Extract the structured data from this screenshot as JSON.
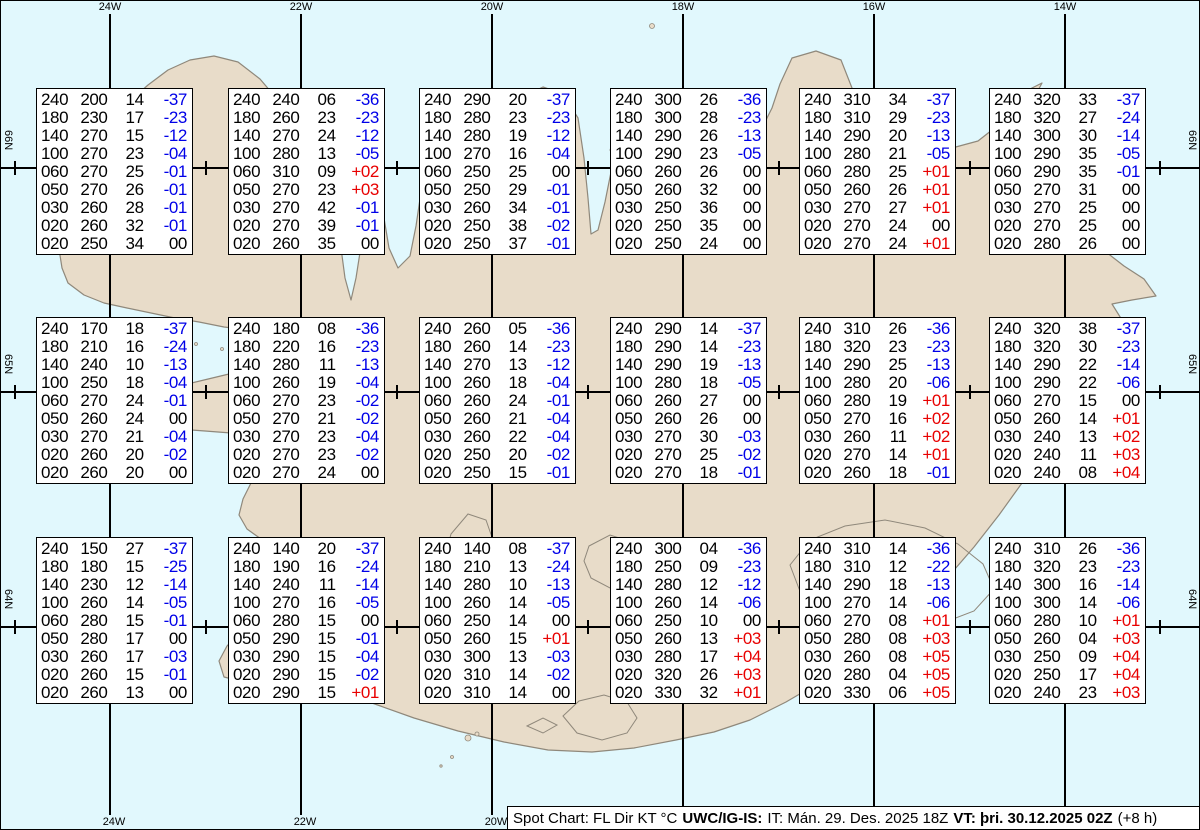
{
  "chart_title": "Spot Chart",
  "map": {
    "region": "Iceland",
    "colors": {
      "water": "#e1f8fd",
      "land": "#e8dcc9",
      "coast": "#8f887b",
      "glacier_outline": "#8d8d8d",
      "grid": "#000000"
    },
    "meridians": [
      {
        "label": "24W",
        "x": 110,
        "bottom_label": true
      },
      {
        "label": "22W",
        "x": 301,
        "bottom_label": true
      },
      {
        "label": "20W",
        "x": 492,
        "bottom_label": true
      },
      {
        "label": "18W",
        "x": 683,
        "bottom_label": false
      },
      {
        "label": "16W",
        "x": 874,
        "bottom_label": false
      },
      {
        "label": "14W",
        "x": 1065,
        "bottom_label": false
      }
    ],
    "parallels": [
      {
        "label": "66N",
        "y": 168
      },
      {
        "label": "65N",
        "y": 392
      },
      {
        "label": "64N",
        "y": 627
      }
    ],
    "half_degree_tick_x": [
      15,
      206,
      397,
      588,
      779,
      970,
      1160
    ]
  },
  "columns": {
    "flight_level": "FL",
    "direction": "Dir",
    "speed": "KT",
    "temperature": "°C"
  },
  "colors": {
    "negative_temp": "#0000e8",
    "positive_temp": "#e80000",
    "zero_temp": "#000000"
  },
  "status_bar": {
    "prefix": "Spot Chart: FL Dir KT °C",
    "source": "UWC/IG-IS:",
    "issue_time": "IT: Mán. 29. Des. 2025 18Z",
    "valid_time": "VT: þri. 30.12.2025 02Z",
    "offset": "(+8 h)"
  },
  "spot_boxes": [
    {
      "row": 0,
      "col": 0,
      "levels": [
        [
          "240",
          "200",
          "14",
          "-37"
        ],
        [
          "180",
          "230",
          "17",
          "-23"
        ],
        [
          "140",
          "270",
          "15",
          "-12"
        ],
        [
          "100",
          "270",
          "23",
          "-04"
        ],
        [
          "060",
          "270",
          "25",
          "-01"
        ],
        [
          "050",
          "270",
          "26",
          "-01"
        ],
        [
          "030",
          "260",
          "28",
          "-01"
        ],
        [
          "020",
          "260",
          "32",
          "-01"
        ],
        [
          "020",
          "250",
          "34",
          "00"
        ]
      ]
    },
    {
      "row": 0,
      "col": 1,
      "levels": [
        [
          "240",
          "240",
          "06",
          "-36"
        ],
        [
          "180",
          "260",
          "23",
          "-23"
        ],
        [
          "140",
          "270",
          "24",
          "-12"
        ],
        [
          "100",
          "280",
          "13",
          "-05"
        ],
        [
          "060",
          "310",
          "09",
          "+02"
        ],
        [
          "050",
          "270",
          "23",
          "+03"
        ],
        [
          "030",
          "270",
          "42",
          "-01"
        ],
        [
          "020",
          "270",
          "39",
          "-01"
        ],
        [
          "020",
          "260",
          "35",
          "00"
        ]
      ]
    },
    {
      "row": 0,
      "col": 2,
      "levels": [
        [
          "240",
          "290",
          "20",
          "-37"
        ],
        [
          "180",
          "280",
          "23",
          "-23"
        ],
        [
          "140",
          "280",
          "19",
          "-12"
        ],
        [
          "100",
          "270",
          "16",
          "-04"
        ],
        [
          "060",
          "250",
          "25",
          "00"
        ],
        [
          "050",
          "250",
          "29",
          "-01"
        ],
        [
          "030",
          "260",
          "34",
          "-01"
        ],
        [
          "020",
          "250",
          "38",
          "-02"
        ],
        [
          "020",
          "250",
          "37",
          "-01"
        ]
      ]
    },
    {
      "row": 0,
      "col": 3,
      "levels": [
        [
          "240",
          "300",
          "26",
          "-36"
        ],
        [
          "180",
          "300",
          "28",
          "-23"
        ],
        [
          "140",
          "290",
          "26",
          "-13"
        ],
        [
          "100",
          "290",
          "23",
          "-05"
        ],
        [
          "060",
          "260",
          "26",
          "00"
        ],
        [
          "050",
          "260",
          "32",
          "00"
        ],
        [
          "030",
          "250",
          "36",
          "00"
        ],
        [
          "020",
          "250",
          "35",
          "00"
        ],
        [
          "020",
          "250",
          "24",
          "00"
        ]
      ]
    },
    {
      "row": 0,
      "col": 4,
      "levels": [
        [
          "240",
          "310",
          "34",
          "-37"
        ],
        [
          "180",
          "310",
          "29",
          "-23"
        ],
        [
          "140",
          "290",
          "20",
          "-13"
        ],
        [
          "100",
          "280",
          "21",
          "-05"
        ],
        [
          "060",
          "280",
          "25",
          "+01"
        ],
        [
          "050",
          "260",
          "26",
          "+01"
        ],
        [
          "030",
          "270",
          "27",
          "+01"
        ],
        [
          "020",
          "270",
          "24",
          "00"
        ],
        [
          "020",
          "270",
          "24",
          "+01"
        ]
      ]
    },
    {
      "row": 0,
      "col": 5,
      "levels": [
        [
          "240",
          "320",
          "33",
          "-37"
        ],
        [
          "180",
          "320",
          "27",
          "-24"
        ],
        [
          "140",
          "300",
          "30",
          "-14"
        ],
        [
          "100",
          "290",
          "35",
          "-05"
        ],
        [
          "060",
          "290",
          "35",
          "-01"
        ],
        [
          "050",
          "270",
          "31",
          "00"
        ],
        [
          "030",
          "270",
          "25",
          "00"
        ],
        [
          "020",
          "270",
          "25",
          "00"
        ],
        [
          "020",
          "280",
          "26",
          "00"
        ]
      ]
    },
    {
      "row": 1,
      "col": 0,
      "levels": [
        [
          "240",
          "170",
          "18",
          "-37"
        ],
        [
          "180",
          "210",
          "16",
          "-24"
        ],
        [
          "140",
          "240",
          "10",
          "-13"
        ],
        [
          "100",
          "250",
          "18",
          "-04"
        ],
        [
          "060",
          "270",
          "24",
          "-01"
        ],
        [
          "050",
          "260",
          "24",
          "00"
        ],
        [
          "030",
          "270",
          "21",
          "-04"
        ],
        [
          "020",
          "260",
          "20",
          "-02"
        ],
        [
          "020",
          "260",
          "20",
          "00"
        ]
      ]
    },
    {
      "row": 1,
      "col": 1,
      "levels": [
        [
          "240",
          "180",
          "08",
          "-36"
        ],
        [
          "180",
          "220",
          "16",
          "-23"
        ],
        [
          "140",
          "280",
          "11",
          "-13"
        ],
        [
          "100",
          "260",
          "19",
          "-04"
        ],
        [
          "060",
          "270",
          "23",
          "-02"
        ],
        [
          "050",
          "270",
          "21",
          "-02"
        ],
        [
          "030",
          "270",
          "23",
          "-04"
        ],
        [
          "020",
          "270",
          "23",
          "-02"
        ],
        [
          "020",
          "270",
          "24",
          "00"
        ]
      ]
    },
    {
      "row": 1,
      "col": 2,
      "levels": [
        [
          "240",
          "260",
          "05",
          "-36"
        ],
        [
          "180",
          "260",
          "14",
          "-23"
        ],
        [
          "140",
          "270",
          "13",
          "-12"
        ],
        [
          "100",
          "260",
          "18",
          "-04"
        ],
        [
          "060",
          "260",
          "24",
          "-01"
        ],
        [
          "050",
          "260",
          "21",
          "-04"
        ],
        [
          "030",
          "260",
          "22",
          "-04"
        ],
        [
          "020",
          "250",
          "20",
          "-02"
        ],
        [
          "020",
          "250",
          "15",
          "-01"
        ]
      ]
    },
    {
      "row": 1,
      "col": 3,
      "levels": [
        [
          "240",
          "290",
          "14",
          "-37"
        ],
        [
          "180",
          "290",
          "14",
          "-23"
        ],
        [
          "140",
          "290",
          "19",
          "-13"
        ],
        [
          "100",
          "280",
          "18",
          "-05"
        ],
        [
          "060",
          "260",
          "27",
          "00"
        ],
        [
          "050",
          "260",
          "26",
          "00"
        ],
        [
          "030",
          "270",
          "30",
          "-03"
        ],
        [
          "020",
          "270",
          "25",
          "-02"
        ],
        [
          "020",
          "270",
          "18",
          "-01"
        ]
      ]
    },
    {
      "row": 1,
      "col": 4,
      "levels": [
        [
          "240",
          "310",
          "26",
          "-36"
        ],
        [
          "180",
          "320",
          "23",
          "-23"
        ],
        [
          "140",
          "290",
          "25",
          "-13"
        ],
        [
          "100",
          "280",
          "20",
          "-06"
        ],
        [
          "060",
          "280",
          "19",
          "+01"
        ],
        [
          "050",
          "270",
          "16",
          "+02"
        ],
        [
          "030",
          "260",
          "11",
          "+02"
        ],
        [
          "020",
          "270",
          "14",
          "+01"
        ],
        [
          "020",
          "260",
          "18",
          "-01"
        ]
      ]
    },
    {
      "row": 1,
      "col": 5,
      "levels": [
        [
          "240",
          "320",
          "38",
          "-37"
        ],
        [
          "180",
          "320",
          "30",
          "-23"
        ],
        [
          "140",
          "290",
          "22",
          "-14"
        ],
        [
          "100",
          "290",
          "22",
          "-06"
        ],
        [
          "060",
          "270",
          "15",
          "00"
        ],
        [
          "050",
          "260",
          "14",
          "+01"
        ],
        [
          "030",
          "240",
          "13",
          "+02"
        ],
        [
          "020",
          "240",
          "11",
          "+03"
        ],
        [
          "020",
          "240",
          "08",
          "+04"
        ]
      ]
    },
    {
      "row": 2,
      "col": 0,
      "levels": [
        [
          "240",
          "150",
          "27",
          "-37"
        ],
        [
          "180",
          "180",
          "15",
          "-25"
        ],
        [
          "140",
          "230",
          "12",
          "-14"
        ],
        [
          "100",
          "260",
          "14",
          "-05"
        ],
        [
          "060",
          "280",
          "15",
          "-01"
        ],
        [
          "050",
          "280",
          "17",
          "00"
        ],
        [
          "030",
          "260",
          "17",
          "-03"
        ],
        [
          "020",
          "260",
          "15",
          "-01"
        ],
        [
          "020",
          "260",
          "13",
          "00"
        ]
      ]
    },
    {
      "row": 2,
      "col": 1,
      "levels": [
        [
          "240",
          "140",
          "20",
          "-37"
        ],
        [
          "180",
          "190",
          "16",
          "-24"
        ],
        [
          "140",
          "240",
          "11",
          "-14"
        ],
        [
          "100",
          "270",
          "16",
          "-05"
        ],
        [
          "060",
          "280",
          "15",
          "00"
        ],
        [
          "050",
          "290",
          "15",
          "-01"
        ],
        [
          "030",
          "290",
          "15",
          "-04"
        ],
        [
          "020",
          "290",
          "15",
          "-02"
        ],
        [
          "020",
          "290",
          "15",
          "+01"
        ]
      ]
    },
    {
      "row": 2,
      "col": 2,
      "levels": [
        [
          "240",
          "140",
          "08",
          "-37"
        ],
        [
          "180",
          "210",
          "13",
          "-24"
        ],
        [
          "140",
          "280",
          "10",
          "-13"
        ],
        [
          "100",
          "260",
          "14",
          "-05"
        ],
        [
          "060",
          "250",
          "14",
          "00"
        ],
        [
          "050",
          "260",
          "15",
          "+01"
        ],
        [
          "030",
          "300",
          "13",
          "-03"
        ],
        [
          "020",
          "310",
          "14",
          "-02"
        ],
        [
          "020",
          "310",
          "14",
          "00"
        ]
      ]
    },
    {
      "row": 2,
      "col": 3,
      "levels": [
        [
          "240",
          "300",
          "04",
          "-36"
        ],
        [
          "180",
          "250",
          "09",
          "-23"
        ],
        [
          "140",
          "280",
          "12",
          "-12"
        ],
        [
          "100",
          "260",
          "14",
          "-06"
        ],
        [
          "060",
          "250",
          "10",
          "00"
        ],
        [
          "050",
          "260",
          "13",
          "+03"
        ],
        [
          "030",
          "280",
          "17",
          "+04"
        ],
        [
          "020",
          "320",
          "26",
          "+03"
        ],
        [
          "020",
          "330",
          "32",
          "+01"
        ]
      ]
    },
    {
      "row": 2,
      "col": 4,
      "levels": [
        [
          "240",
          "310",
          "14",
          "-36"
        ],
        [
          "180",
          "310",
          "12",
          "-22"
        ],
        [
          "140",
          "290",
          "18",
          "-13"
        ],
        [
          "100",
          "270",
          "14",
          "-06"
        ],
        [
          "060",
          "270",
          "08",
          "+01"
        ],
        [
          "050",
          "280",
          "08",
          "+03"
        ],
        [
          "030",
          "260",
          "08",
          "+05"
        ],
        [
          "020",
          "280",
          "04",
          "+05"
        ],
        [
          "020",
          "330",
          "06",
          "+05"
        ]
      ]
    },
    {
      "row": 2,
      "col": 5,
      "levels": [
        [
          "240",
          "310",
          "26",
          "-36"
        ],
        [
          "180",
          "320",
          "23",
          "-23"
        ],
        [
          "140",
          "300",
          "16",
          "-14"
        ],
        [
          "100",
          "300",
          "14",
          "-06"
        ],
        [
          "060",
          "280",
          "10",
          "+01"
        ],
        [
          "050",
          "260",
          "04",
          "+03"
        ],
        [
          "030",
          "250",
          "09",
          "+04"
        ],
        [
          "020",
          "250",
          "17",
          "+04"
        ],
        [
          "020",
          "240",
          "23",
          "+03"
        ]
      ]
    }
  ]
}
